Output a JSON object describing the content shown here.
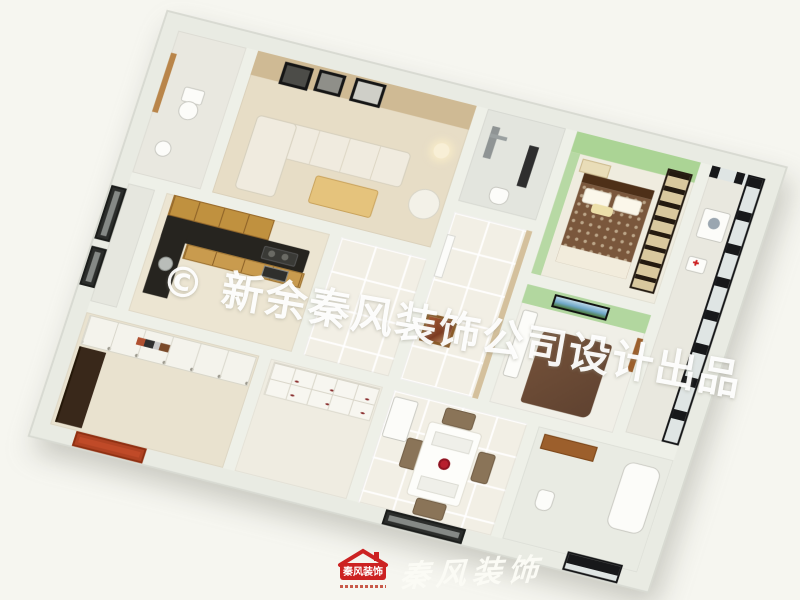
{
  "watermark": {
    "text": "© 新余秦风装饰公司设计出品"
  },
  "logo": {
    "badge_text": "秦风装饰",
    "calligraphy": "秦风装饰"
  },
  "palette": {
    "page_background": "#f6f6f0",
    "exterior_wall": "#e9ebe3",
    "tile_floor": "#f2efe5",
    "living_wall_beige": "#cfba94",
    "bedroom_wall_green": "#aed49a",
    "kitchen_cabinet_wood": "#c0913f",
    "kitchen_counter_black": "#26241f",
    "entry_door_red": "#c04a28",
    "balcony_frame_black": "#17181a",
    "logo_red": "#cc2222",
    "watermark_white": "#ffffff"
  },
  "floorplan": {
    "type": "3d-apartment-render",
    "rooms": [
      {
        "name": "bathroom-1",
        "wall_color": "#eceee6"
      },
      {
        "name": "living-room",
        "wall_color": "#cfba94"
      },
      {
        "name": "shower-room",
        "wall_color": "#e3e5de"
      },
      {
        "name": "hallway",
        "wall_color": "#d4c09c"
      },
      {
        "name": "master-bedroom",
        "wall_color": "#aed49a"
      },
      {
        "name": "balcony",
        "wall_color": "#17181a"
      },
      {
        "name": "kitchen",
        "wall_color": "#c0913f"
      },
      {
        "name": "bedroom-2",
        "wall_color": "#b2d79f"
      },
      {
        "name": "bedroom-3",
        "wall_color": "#f4f3ec"
      },
      {
        "name": "storage-room",
        "wall_color": "#f7f6f0"
      },
      {
        "name": "dining-area",
        "wall_color": "#f2efe5"
      },
      {
        "name": "bathroom-2",
        "wall_color": "#e9ebe3"
      }
    ]
  }
}
